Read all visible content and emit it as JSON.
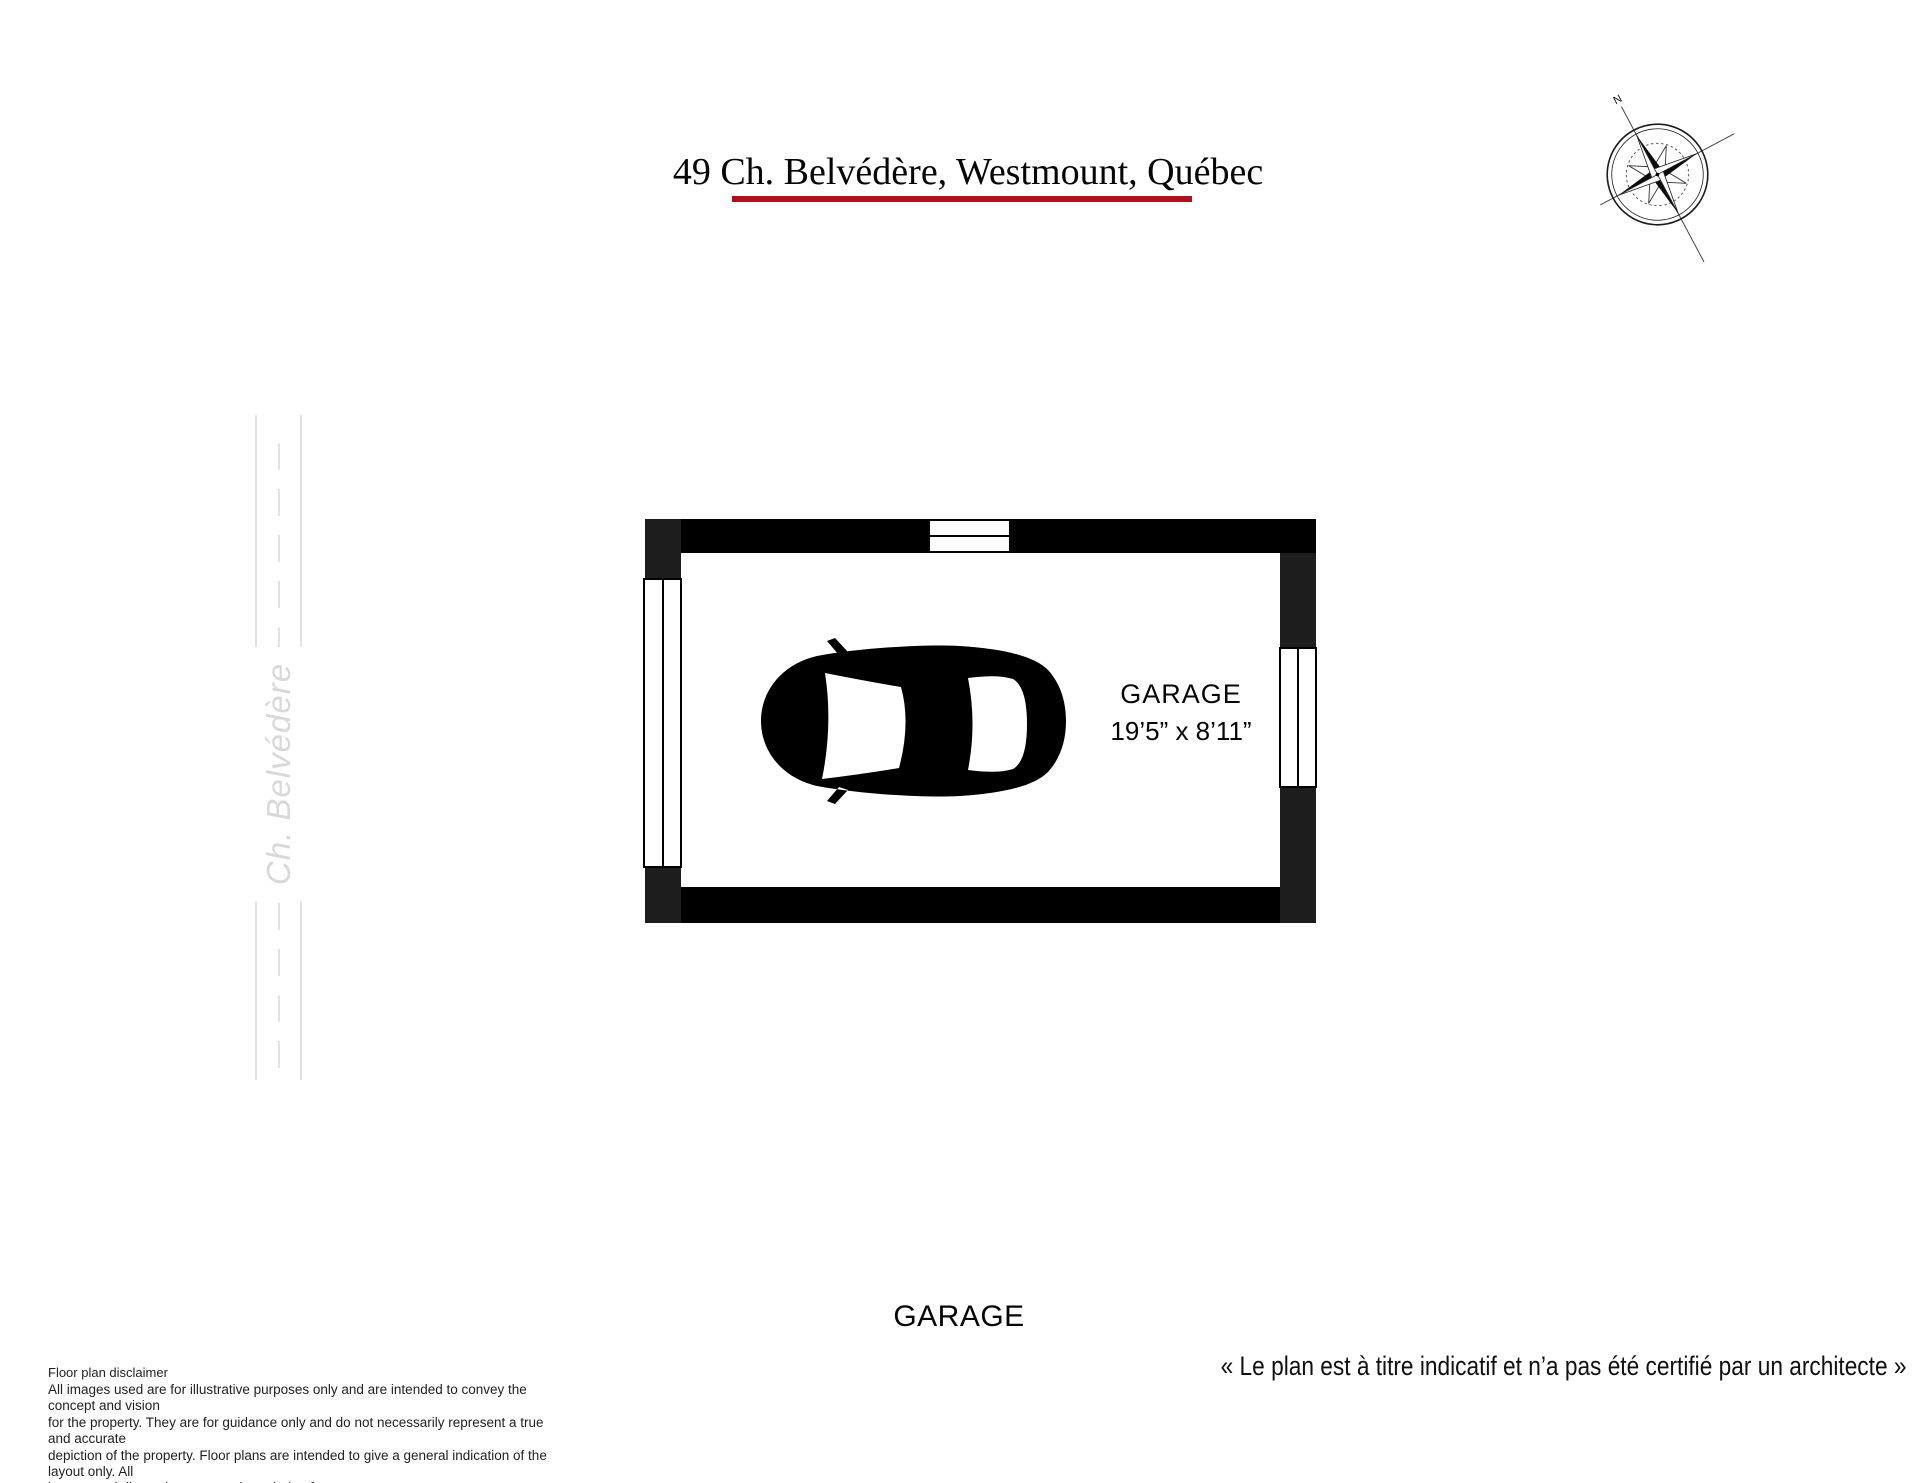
{
  "title": "49 Ch. Belvédère, Westmount, Québec",
  "colors": {
    "accent": "#b0101c",
    "wall": "#000000",
    "wall_alt": "#1d1d1d",
    "road_line": "#e3e3e3",
    "street_text": "#d9d9d9"
  },
  "compass": {
    "north": "N"
  },
  "street": {
    "name": "Ch. Belvédère"
  },
  "plan": {
    "room_label": "GARAGE",
    "room_dimensions": "19’5” x 8’11”",
    "car_icon": "car-top-view",
    "features": [
      "garage-door-top",
      "window-left",
      "window-right"
    ]
  },
  "footer": {
    "floor_label": "GARAGE",
    "disclaimer_title": "Floor plan disclaimer",
    "disclaimer_body": "All images used are for illustrative purposes only and are intended to convey the concept and vision\nfor the property. They are for guidance only and do not necessarily represent a true and accurate\ndepiction of the property. Floor plans are intended to give a general indication of the layout only. All\nimages and dimensions are not intended to form any contract or warranty.",
    "certification_note": "« Le plan est à titre indicatif et n’a pas été certifié par un architecte »"
  }
}
